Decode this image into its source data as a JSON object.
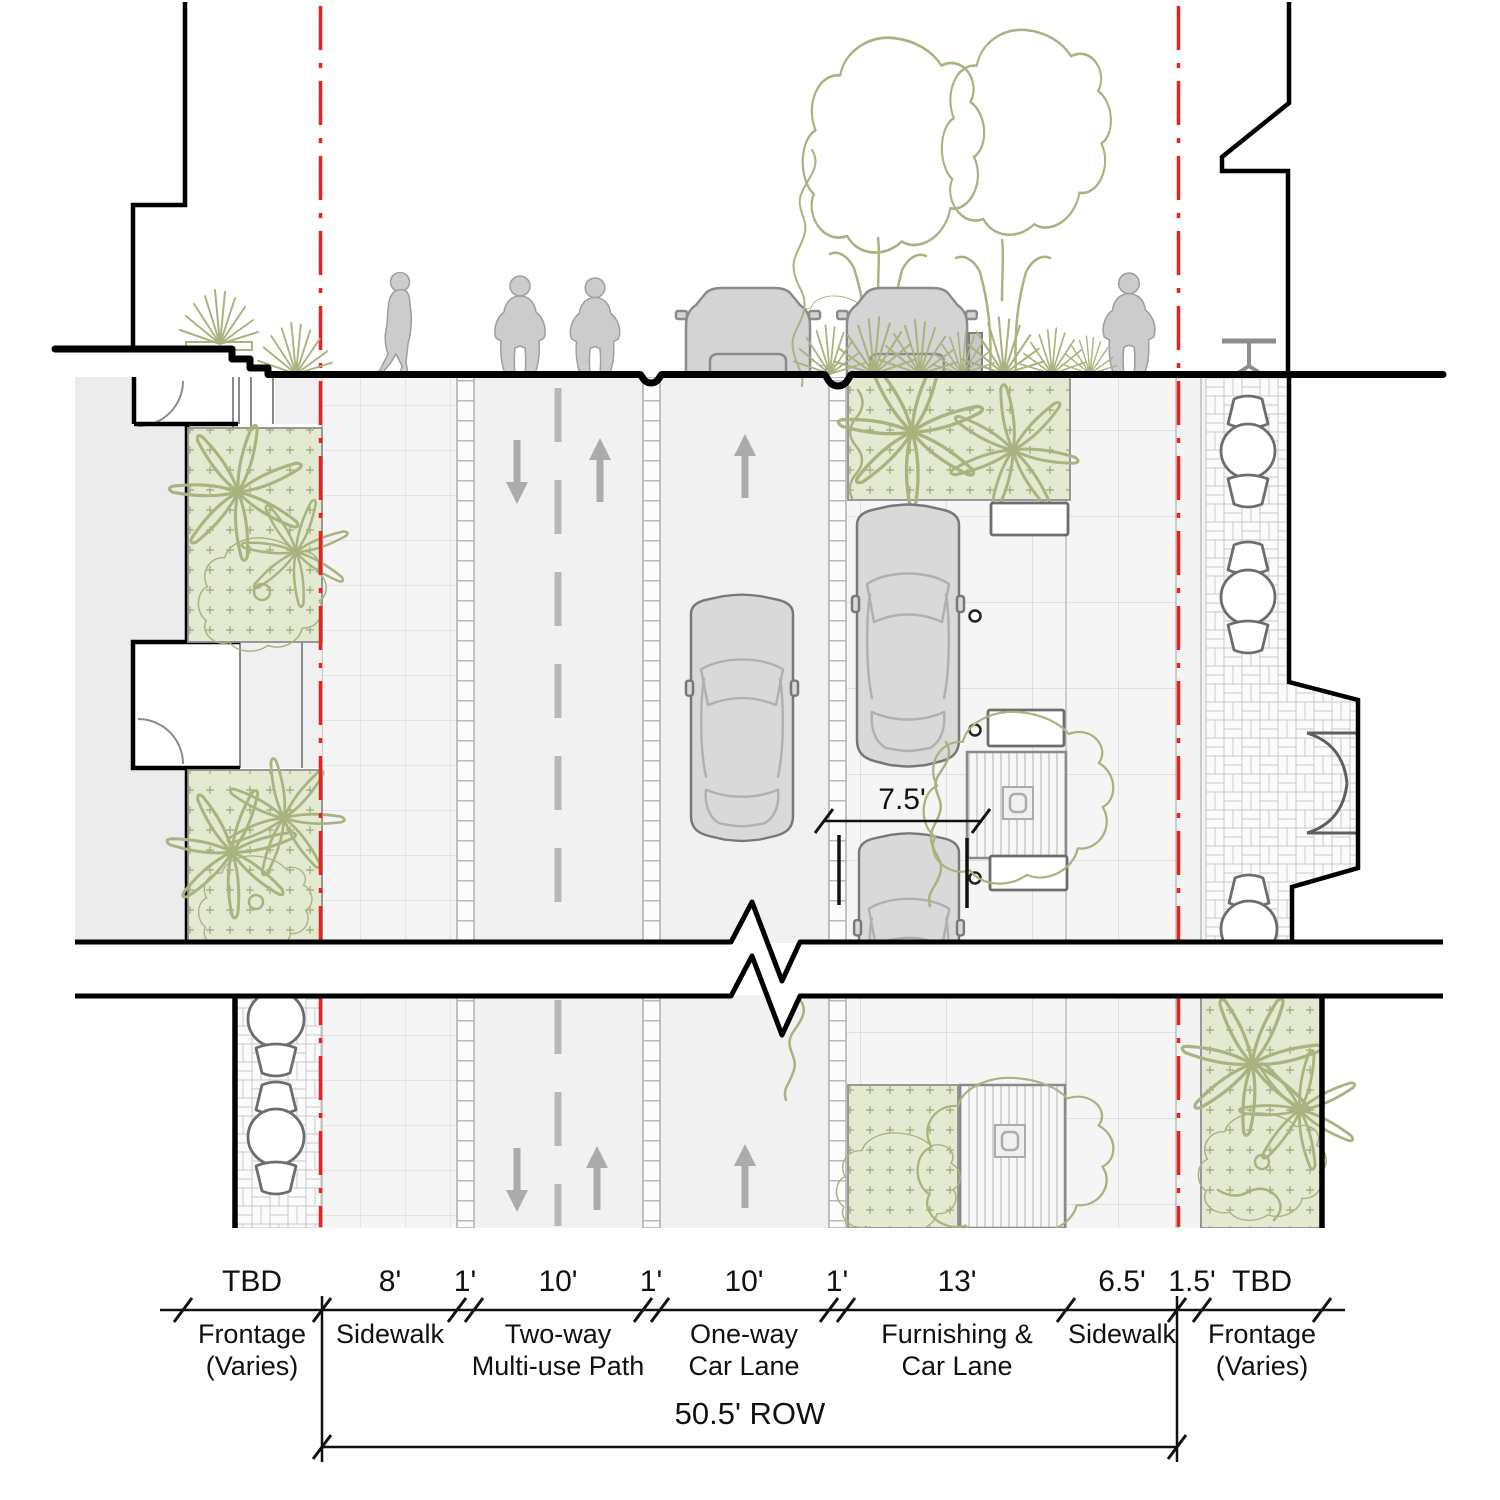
{
  "dims": {
    "segments": [
      {
        "label": "TBD"
      },
      {
        "label": "8'"
      },
      {
        "label": "1'"
      },
      {
        "label": "10'"
      },
      {
        "label": "1'"
      },
      {
        "label": "10'"
      },
      {
        "label": "1'"
      },
      {
        "label": "13'"
      },
      {
        "label": "6.5'"
      },
      {
        "label": "1.5'"
      },
      {
        "label": "TBD"
      }
    ],
    "row_label": "50.5'  ROW",
    "stall_label": "7.5'"
  },
  "zones": [
    {
      "line1": "Frontage",
      "line2": "(Varies)"
    },
    {
      "line1": "Sidewalk",
      "line2": ""
    },
    {
      "line1": "Two-way",
      "line2": "Multi-use Path"
    },
    {
      "line1": "One-way",
      "line2": "Car Lane"
    },
    {
      "line1": "Furnishing &",
      "line2": "Car Lane"
    },
    {
      "line1": "Sidewalk",
      "line2": ""
    },
    {
      "line1": "Frontage",
      "line2": "(Varies)"
    }
  ],
  "colors": {
    "row_line": "#e8231f",
    "plant_line": "#a9b380",
    "plant_fill": "#e4e9d2",
    "figure_fill": "#cccccc"
  }
}
